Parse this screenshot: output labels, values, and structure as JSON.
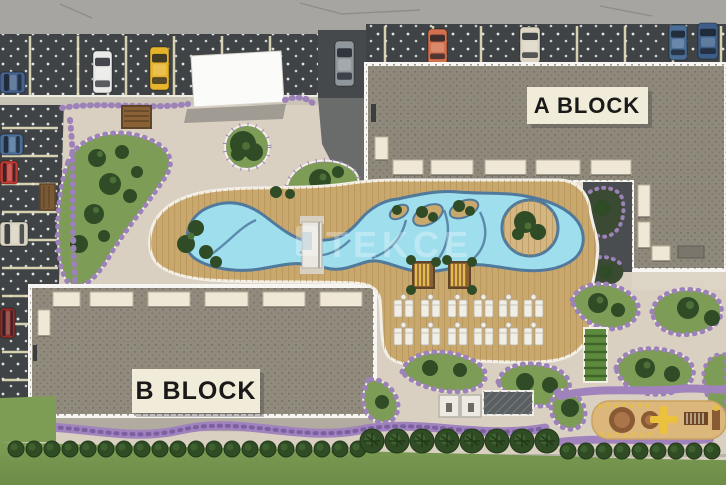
{
  "scene": {
    "type": "residential-complex-site-plan-render",
    "width": 726,
    "height": 485
  },
  "labels": {
    "block_a": "A BLOCK",
    "block_b": "B BLOCK"
  },
  "watermark": {
    "text": "TEKCE",
    "opacity": 0.3
  },
  "palette": {
    "road": "#a6a5a1",
    "asphalt": "#3f4345",
    "stall_line": "#e7e2bd",
    "plaza": "#d9d0c1",
    "deck": "#c9a86e",
    "deck_line": "#ad8a50",
    "pool_water": "#9edeed",
    "pool_border": "#51799c",
    "roof": "#8f897c",
    "roof_speckle": "#6c675d",
    "border_white": "#f7f6f2",
    "awning": "#efe8d6",
    "plate": "#f1ebd9",
    "lawn": "#76974f",
    "garden": "#7d9c55",
    "tree": "#2f4c26",
    "flowers": "#9c82b8",
    "sand": "#dcb77c",
    "pergola_wood": "#8a6137",
    "pergola_glow": "#e5bb4d",
    "lounger": "#f1eee6"
  },
  "parking": {
    "top_cars": [
      {
        "color": "#e9e9e7",
        "x": 93,
        "y": 51,
        "w": 19,
        "h": 42,
        "dir": "v"
      },
      {
        "color": "#e6b32a",
        "x": 150,
        "y": 47,
        "w": 19,
        "h": 43,
        "dir": "v"
      },
      {
        "color": "#8f969c",
        "x": 335,
        "y": 41,
        "w": 19,
        "h": 45,
        "dir": "v"
      },
      {
        "color": "#d3704d",
        "x": 428,
        "y": 29,
        "w": 19,
        "h": 35,
        "dir": "v"
      },
      {
        "color": "#ddd6c5",
        "x": 520,
        "y": 27,
        "w": 20,
        "h": 36,
        "dir": "v"
      },
      {
        "color": "#4a6e96",
        "x": 669,
        "y": 25,
        "w": 18,
        "h": 35,
        "dir": "v"
      },
      {
        "color": "#3c5e89",
        "x": 698,
        "y": 23,
        "w": 20,
        "h": 36,
        "dir": "v"
      }
    ],
    "left_cars": [
      {
        "color": "#45628c",
        "x": 0,
        "y": 72,
        "w": 25,
        "h": 21,
        "dir": "h"
      },
      {
        "color": "#4a6e96",
        "x": 0,
        "y": 134,
        "w": 23,
        "h": 21,
        "dir": "h"
      },
      {
        "color": "#bf3a31",
        "x": 0,
        "y": 161,
        "w": 18,
        "h": 23,
        "dir": "h"
      },
      {
        "color": "#d8d2c0",
        "x": 0,
        "y": 222,
        "w": 28,
        "h": 24,
        "dir": "h"
      },
      {
        "color": "#8c2f2a",
        "x": 0,
        "y": 308,
        "w": 15,
        "h": 30,
        "dir": "h"
      }
    ],
    "stalls": {
      "top_xs": [
        30,
        78,
        126,
        174,
        222,
        270
      ],
      "right_xs": [
        385,
        433,
        481,
        529,
        577,
        625,
        673,
        721
      ],
      "left_ys": [
        128,
        156,
        184,
        212,
        240,
        268,
        296,
        324,
        352,
        380
      ]
    }
  },
  "buildings": {
    "block_a": {
      "awnings": [
        [
          393,
          160,
          30,
          15
        ],
        [
          431,
          160,
          42,
          15
        ],
        [
          485,
          160,
          41,
          15
        ],
        [
          536,
          160,
          44,
          15
        ],
        [
          591,
          160,
          40,
          15
        ],
        [
          375,
          137,
          13,
          23
        ],
        [
          638,
          185,
          12,
          32
        ],
        [
          638,
          222,
          12,
          26
        ],
        [
          652,
          246,
          18,
          15
        ]
      ]
    },
    "block_b": {
      "awnings": [
        [
          53,
          292,
          27,
          15
        ],
        [
          90,
          292,
          43,
          15
        ],
        [
          148,
          292,
          42,
          15
        ],
        [
          205,
          292,
          43,
          15
        ],
        [
          263,
          292,
          42,
          15
        ],
        [
          320,
          292,
          42,
          15
        ],
        [
          38,
          310,
          12,
          26
        ]
      ]
    }
  },
  "amenities": {
    "sun_lounger_cols": [
      394,
      421,
      448,
      474,
      499,
      524
    ],
    "sun_lounger_rows": [
      300,
      328
    ],
    "pergola_cabanas": 2,
    "changing_cabins": 2,
    "kids_pool_island": 1,
    "playground": 1
  },
  "hedge": {
    "left": {
      "start": 16,
      "step": 18,
      "count": 20,
      "y": 449,
      "r": 8
    },
    "palms": {
      "start": 372,
      "step": 25,
      "count": 8,
      "y": 441,
      "r": 12
    },
    "right": {
      "start": 568,
      "step": 18,
      "count": 9,
      "y": 451,
      "r": 8
    }
  }
}
